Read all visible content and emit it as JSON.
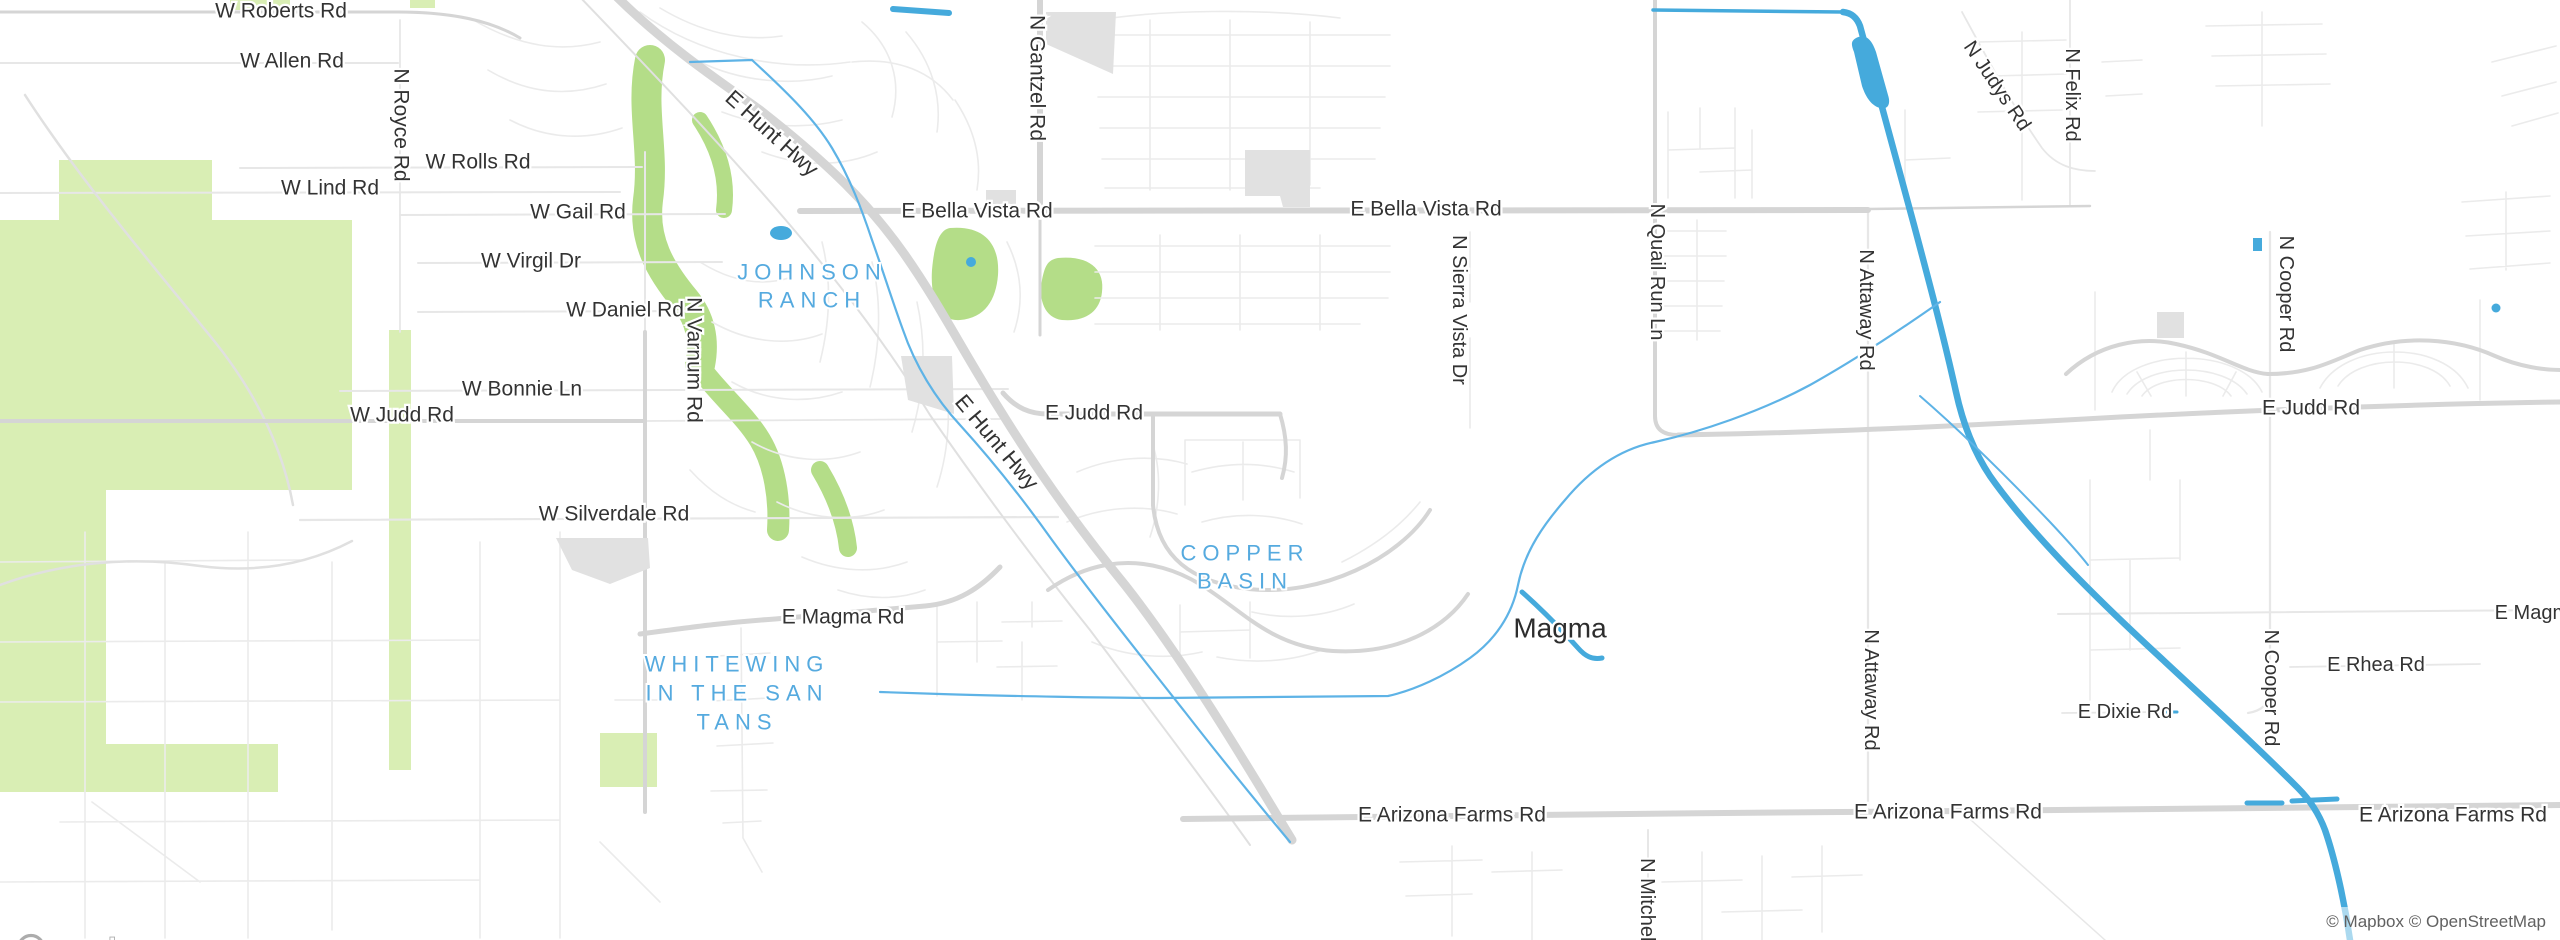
{
  "map": {
    "attribution": "© Mapbox © OpenStreetMap",
    "logo_text": "mapbox",
    "colors": {
      "background": "#ffffff",
      "water": "#45aadc",
      "water_light": "#5eb3e6",
      "park": "#d9eeb4",
      "golf": "#b4dd88",
      "road_major": "#d5d5d5",
      "road_minor": "#e7e7e7",
      "building": "#e1e1e1",
      "road_label": "#333333",
      "area_label": "#55aadf",
      "attribution_text": "#616161"
    },
    "place_labels": [
      {
        "text": "Magma",
        "x": 1560,
        "y": 628,
        "rot": 0,
        "size": 28,
        "kind": "place"
      }
    ],
    "labels": [
      {
        "text": "W Roberts Rd",
        "x": 281,
        "y": 11,
        "rot": 0,
        "size": 21,
        "kind": "road"
      },
      {
        "text": "W Allen Rd",
        "x": 292,
        "y": 61,
        "rot": 0,
        "size": 21,
        "kind": "road"
      },
      {
        "text": "N Royce Rd",
        "x": 401,
        "y": 125,
        "rot": 90,
        "size": 21,
        "kind": "road"
      },
      {
        "text": "W Rolls Rd",
        "x": 478,
        "y": 162,
        "rot": 0,
        "size": 21,
        "kind": "road"
      },
      {
        "text": "W Lind Rd",
        "x": 330,
        "y": 188,
        "rot": 0,
        "size": 21,
        "kind": "road"
      },
      {
        "text": "W Gail Rd",
        "x": 578,
        "y": 212,
        "rot": 0,
        "size": 21,
        "kind": "road"
      },
      {
        "text": "W Virgil Dr",
        "x": 531,
        "y": 261,
        "rot": 0,
        "size": 21,
        "kind": "road"
      },
      {
        "text": "W Daniel Rd",
        "x": 625,
        "y": 310,
        "rot": 0,
        "size": 21,
        "kind": "road"
      },
      {
        "text": "N Varnum Rd",
        "x": 694,
        "y": 360,
        "rot": 90,
        "size": 21,
        "kind": "road"
      },
      {
        "text": "W Bonnie Ln",
        "x": 522,
        "y": 389,
        "rot": 0,
        "size": 21,
        "kind": "road"
      },
      {
        "text": "W Judd Rd",
        "x": 402,
        "y": 415,
        "rot": 0,
        "size": 21,
        "kind": "road"
      },
      {
        "text": "W Silverdale Rd",
        "x": 614,
        "y": 514,
        "rot": 0,
        "size": 21,
        "kind": "road"
      },
      {
        "text": "E Hunt Hwy",
        "x": 772,
        "y": 133,
        "rot": 42,
        "size": 22,
        "kind": "road"
      },
      {
        "text": "E Hunt Hwy",
        "x": 997,
        "y": 442,
        "rot": 50,
        "size": 22,
        "kind": "road"
      },
      {
        "text": "E Bella Vista Rd",
        "x": 977,
        "y": 211,
        "rot": 0,
        "size": 21,
        "kind": "road"
      },
      {
        "text": "E Bella Vista Rd",
        "x": 1426,
        "y": 209,
        "rot": 0,
        "size": 21,
        "kind": "road"
      },
      {
        "text": "N Gantzel Rd",
        "x": 1037,
        "y": 78,
        "rot": 90,
        "size": 21,
        "kind": "road"
      },
      {
        "text": "E Judd Rd",
        "x": 1094,
        "y": 413,
        "rot": 0,
        "size": 21,
        "kind": "road"
      },
      {
        "text": "N Sierra Vista Dr",
        "x": 1459,
        "y": 310,
        "rot": 90,
        "size": 20,
        "kind": "road"
      },
      {
        "text": "E Magma Rd",
        "x": 843,
        "y": 617,
        "rot": 0,
        "size": 21,
        "kind": "road"
      },
      {
        "text": "N Quail Run Ln",
        "x": 1657,
        "y": 272,
        "rot": 90,
        "size": 20,
        "kind": "road"
      },
      {
        "text": "N Attaway Rd",
        "x": 1866,
        "y": 310,
        "rot": 90,
        "size": 20,
        "kind": "road"
      },
      {
        "text": "N Attaway Rd",
        "x": 1871,
        "y": 690,
        "rot": 90,
        "size": 20,
        "kind": "road"
      },
      {
        "text": "N Judys Rd",
        "x": 1997,
        "y": 86,
        "rot": 56,
        "size": 20,
        "kind": "road"
      },
      {
        "text": "N Felix Rd",
        "x": 2072,
        "y": 95,
        "rot": 90,
        "size": 20,
        "kind": "road"
      },
      {
        "text": "E Judd Rd",
        "x": 2311,
        "y": 408,
        "rot": 0,
        "size": 21,
        "kind": "road"
      },
      {
        "text": "N Cooper Rd",
        "x": 2286,
        "y": 294,
        "rot": 90,
        "size": 20,
        "kind": "road"
      },
      {
        "text": "N Cooper Rd",
        "x": 2271,
        "y": 688,
        "rot": 90,
        "size": 20,
        "kind": "road"
      },
      {
        "text": "E Magma Rd",
        "x": 2553,
        "y": 613,
        "rot": 0,
        "size": 20,
        "kind": "road"
      },
      {
        "text": "E Rhea Rd",
        "x": 2376,
        "y": 665,
        "rot": 0,
        "size": 20,
        "kind": "road"
      },
      {
        "text": "E Dixie Rd",
        "x": 2125,
        "y": 712,
        "rot": 0,
        "size": 20,
        "kind": "road"
      },
      {
        "text": "E Arizona Farms Rd",
        "x": 1452,
        "y": 815,
        "rot": 0,
        "size": 21,
        "kind": "road"
      },
      {
        "text": "E Arizona Farms Rd",
        "x": 1948,
        "y": 812,
        "rot": 0,
        "size": 21,
        "kind": "road"
      },
      {
        "text": "E Arizona Farms Rd",
        "x": 2453,
        "y": 815,
        "rot": 0,
        "size": 21,
        "kind": "road"
      },
      {
        "text": "N Mitchell",
        "x": 1647,
        "y": 902,
        "rot": 90,
        "size": 20,
        "kind": "road"
      }
    ],
    "area_labels": [
      {
        "id": "johnson-ranch",
        "lines": [
          "JOHNSON",
          "RANCH"
        ],
        "x": 812,
        "y": 272,
        "line_height": 28,
        "size": 22
      },
      {
        "id": "copper-basin",
        "lines": [
          "COPPER",
          "BASIN"
        ],
        "x": 1245,
        "y": 553,
        "line_height": 28,
        "size": 22
      },
      {
        "id": "whitewing-in-the-san-tans",
        "lines": [
          "WHITEWING",
          "IN THE SAN",
          "TANS"
        ],
        "x": 737,
        "y": 664,
        "line_height": 29,
        "size": 22
      }
    ]
  }
}
